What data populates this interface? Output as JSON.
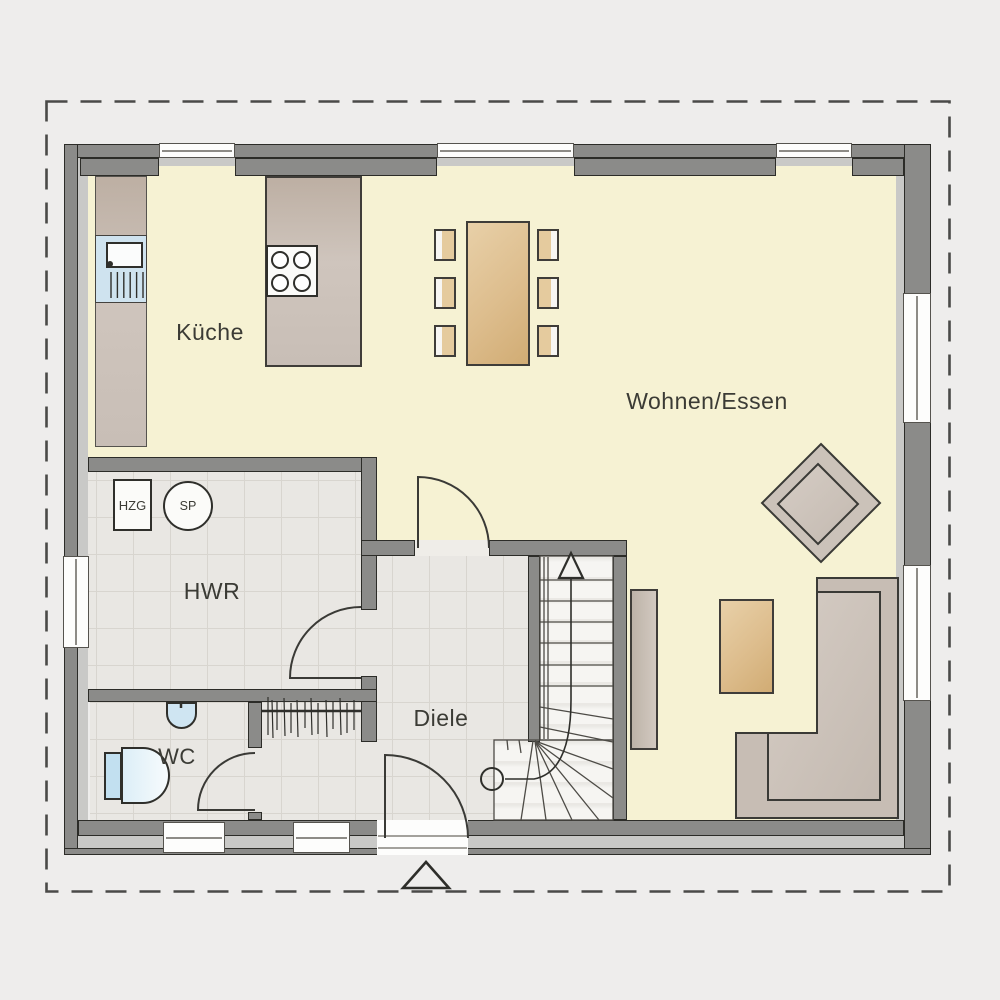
{
  "plan": {
    "rooms": [
      {
        "id": "kueche",
        "label": "Küche"
      },
      {
        "id": "wohnen_essen",
        "label": "Wohnen/Essen"
      },
      {
        "id": "hwr",
        "label": "HWR"
      },
      {
        "id": "wc",
        "label": "WC"
      },
      {
        "id": "diele",
        "label": "Diele"
      }
    ],
    "equipment": [
      {
        "id": "hzg",
        "label": "HZG"
      },
      {
        "id": "sp",
        "label": "SP"
      }
    ],
    "symbols": [
      "stair-direction-arrow",
      "entrance-marker-triangle",
      "plot-boundary-dashed"
    ],
    "colors": {
      "floor_living": "#f6f2d3",
      "floor_tile": "#e9e7e3",
      "wall_dark": "#8b8b89",
      "wall_light": "#c9c9c7",
      "furniture_taupe": "#cbc1b8",
      "wood_tan": "#dcbd8d",
      "water_blue": "#cfe3ef",
      "outside": "#eeedec"
    }
  }
}
